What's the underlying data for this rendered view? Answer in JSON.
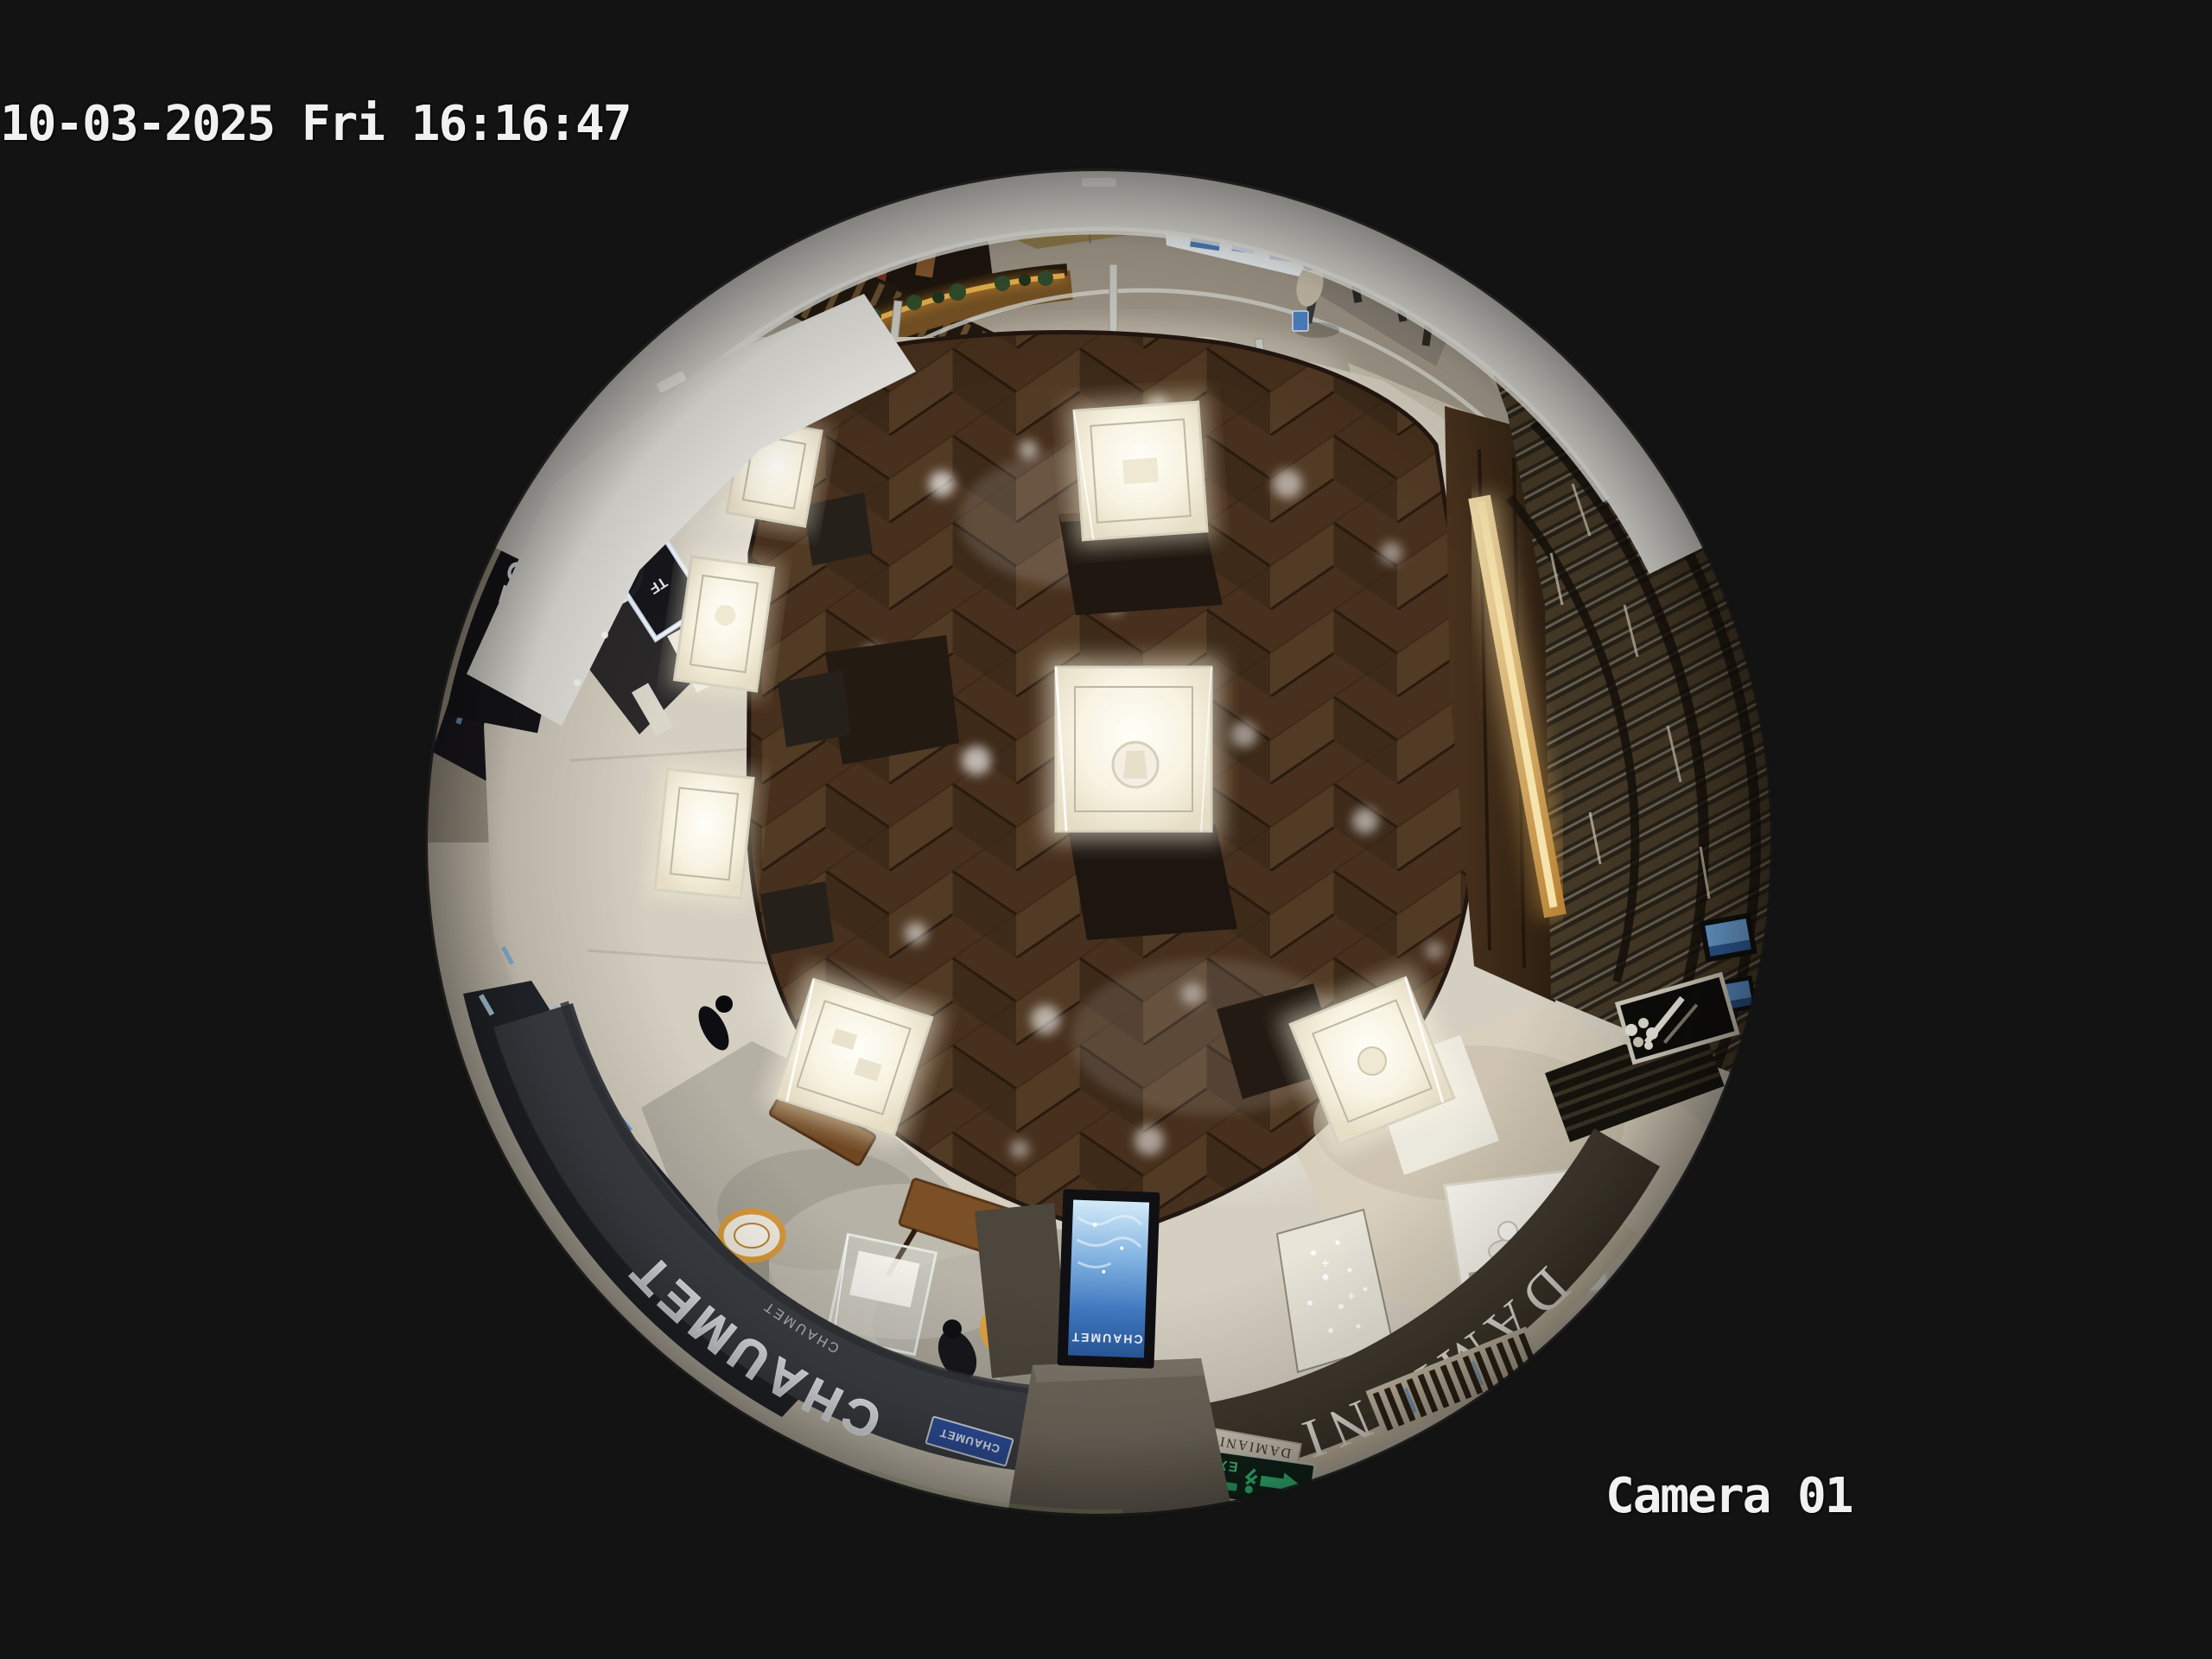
{
  "osd": {
    "timestamp": "10-03-2025 Fri 16:16:47",
    "camera_label": "Camera 01",
    "text_color": "#f1f1f1"
  },
  "scene": {
    "description": "Overhead fisheye security-camera view of a luxury mall jewelry boutique area",
    "storefronts": {
      "chaumet_fascia": "CHAUMET",
      "chaumet_sub": "CHAUMET",
      "damiani_fascia": "DAMIANI",
      "tom_ford_fascia": "TOM FORD",
      "tf_logo": "TF",
      "gold_wall_text": "H.BORCH",
      "totem_screen_brand": "CHAUMET",
      "chaumet_plaque": "CHAUMET",
      "damiani_plaque": "DAMIANI",
      "exit_sign": "EXIT"
    },
    "colors": {
      "background": "#131313",
      "wood_floor": "#4e3722",
      "walkway": "#d5cfc1",
      "mall_floor": "#a29a8b",
      "ceiling_rim": "#e2e2dc",
      "chaumet_fascia": "#3b3e44",
      "damiani_fascia": "#3f382d",
      "tom_ford_fascia": "#131318",
      "case_glow": "#fffdf0",
      "amber_led": "#e0a344",
      "screen_blue": "#4a86c8",
      "exit_green": "#35d084"
    }
  }
}
